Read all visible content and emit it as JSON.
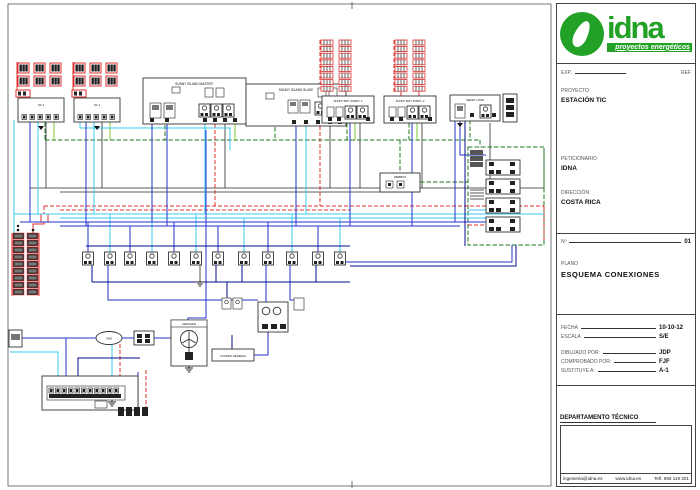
{
  "colors": {
    "brand_green": "#23a127",
    "wire_blue": "#2633c8",
    "wire_dark_blue": "#000c8c",
    "wire_cyan": "#38c8f0",
    "wire_red": "#e03030",
    "wire_data_green": "#1d7a1d",
    "wire_ground_green": "#7ec832",
    "wire_black": "#2a2a2a"
  },
  "title_block": {
    "logo_text": "idna",
    "logo_tagline": "proyectos energéticos",
    "exp_label": "EXP.",
    "ref_label": "REF",
    "proyecto_label": "PROYECTO",
    "proyecto_value": "ESTACIÓN TIC",
    "peticionario_label": "PETICIONARIO",
    "peticionario_value": "IDNA",
    "direccion_label": "DIRECCIÓN",
    "direccion_value": "COSTA RICA",
    "num_label": "Nº",
    "num_value": "01",
    "plano_label": "PLANO",
    "plano_value": "ESQUEMA CONEXIONES",
    "fecha_label": "FECHA",
    "fecha_value": "10-10-12",
    "escala_label": "ESCALA",
    "escala_value": "S/E",
    "dibujado_label": "DIBUJADO POR:",
    "dibujado_value": "JDP",
    "comprobado_label": "COMPROBADO POR:",
    "comprobado_value": "FJF",
    "sustituye_label": "SUSTITUYE A:",
    "sustituye_value": "A-1",
    "departamento_label": "DEPARTAMENTO TÉCNICO",
    "footer": {
      "email": "ingenieria@idna.es",
      "web": "www.idna.es",
      "phone": "Telf. 966 119 201"
    }
  },
  "diagram": {
    "labels": {
      "si_master": "SUNNY ISLAND MASTER",
      "si_slave": "SUNNY ISLAND SLAVE",
      "sb1": "SUNNY BOY 4000TL 1",
      "sb2": "SUNNY BOY 4000TL 2",
      "smart_load": "SMART LOAD",
      "webbox": "WEBBOX",
      "nc2": "NC 2",
      "nc1": "NC 1",
      "aerogen": "AEROGEN",
      "wind_tag": "VND",
      "cuadro": "CUADRO GENERAL"
    }
  }
}
